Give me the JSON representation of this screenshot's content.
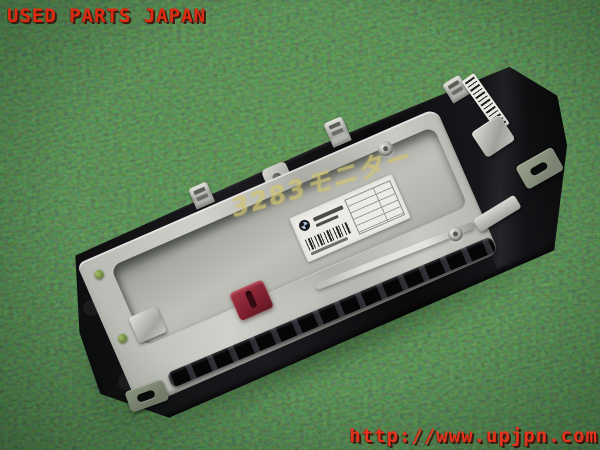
{
  "watermarks": {
    "brand": "USED PARTS JAPAN",
    "url": "http://www.upjpn.com"
  },
  "part": {
    "handwritten_note": "3283モニター",
    "label": {
      "logo_icon": "bmw-roundel-icon",
      "elements": [
        "barcode",
        "spec-table",
        "part-number-text"
      ]
    },
    "features": [
      "aluminum-back-cover",
      "recessed-panel",
      "red-connector",
      "mounting-tabs",
      "vent-slots",
      "barcode-strip-label"
    ]
  },
  "scene": {
    "background": "green-artificial-turf"
  },
  "colors": {
    "turf_green": "#2c5f2b",
    "watermark_red": "#df2a12",
    "aluminum_silver": "#c3c4be",
    "connector_red": "#8e2433",
    "marker_yellow": "#d2c574",
    "plastic_black": "#0d0d0f",
    "label_white": "#eceae4"
  }
}
